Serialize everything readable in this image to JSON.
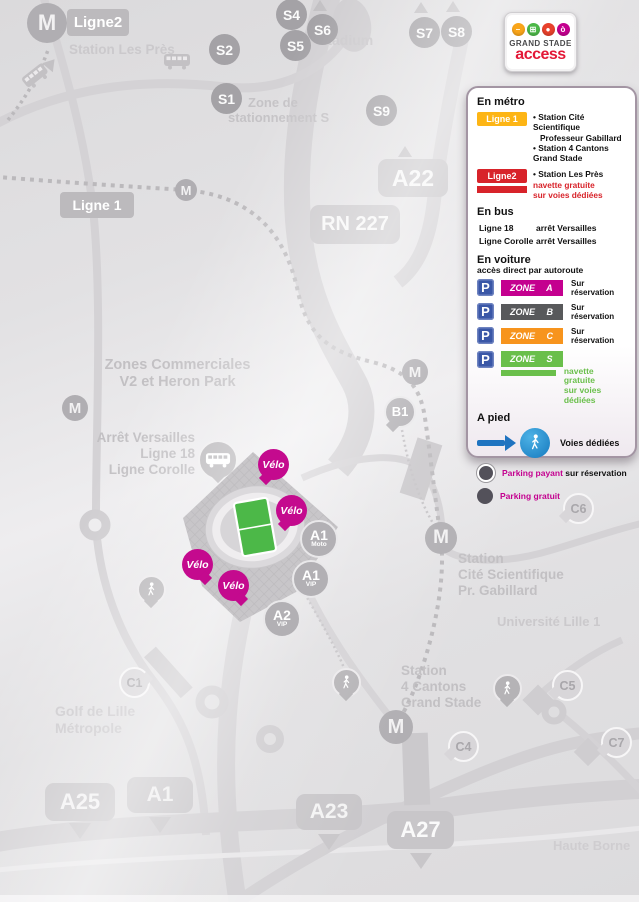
{
  "logo": {
    "brand_line1": "GRAND STADE",
    "brand_line2": "access",
    "icons": [
      {
        "name": "metro-icon",
        "color": "#f9a51a"
      },
      {
        "name": "bus-icon",
        "color": "#4cb848"
      },
      {
        "name": "car-icon",
        "color": "#e8412c"
      },
      {
        "name": "bike-icon",
        "color": "#c4008f"
      }
    ]
  },
  "legend": {
    "metro_heading": "En métro",
    "ligne1_label": "Ligne 1",
    "ligne1_station1a": "• Station Cité Scientifique",
    "ligne1_station1b": "Professeur Gabillard",
    "ligne1_station2": "• Station 4 Cantons Grand Stade",
    "ligne2_label": "Ligne2",
    "ligne2_station": "• Station Les Près",
    "ligne2_note1": "navette gratuite",
    "ligne2_note2": "sur voies dédiées",
    "bus_heading": "En bus",
    "bus_rows": [
      {
        "line": "Ligne 18",
        "stop": "arrêt Versailles"
      },
      {
        "line": "Ligne Corolle",
        "stop": "arrêt Versailles"
      }
    ],
    "car_heading": "En voiture",
    "car_sub": "accès direct par autoroute",
    "p_label": "P",
    "zones": [
      {
        "label": "ZONE A",
        "color": "#c4008f",
        "note": "Sur réservation"
      },
      {
        "label": "ZONE B",
        "color": "#58595b",
        "note": "Sur réservation"
      },
      {
        "label": "ZONE C",
        "color": "#f7941d",
        "note": "Sur réservation"
      },
      {
        "label": "ZONE S",
        "color": "#6abf4b",
        "note1": "navette gratuite",
        "note2": "sur voies dédiées"
      }
    ],
    "foot_heading": "A pied",
    "foot_note": "Voies dédiées",
    "parking_paid_label": "Parking payant",
    "parking_paid_suffix": " sur réservation",
    "parking_free_label": "Parking gratuit"
  },
  "map": {
    "m": "M",
    "ligne2_label": "Ligne2",
    "station_les_pres": "Station Les Près",
    "s_markers": [
      "S1",
      "S2",
      "S4",
      "S5",
      "S6",
      "S7",
      "S8",
      "S9"
    ],
    "stadium_text": "Stadium",
    "zone_stationnement1": "Zone de",
    "zone_stationnement2": "stationnement S",
    "ligne1_label": "Ligne 1",
    "rn227": "RN 227",
    "a22": "A22",
    "zones_comm1": "Zones Commerciales",
    "zones_comm2": "V2 et Heron Park",
    "arret1": "Arrêt Versailles",
    "arret2": "Ligne 18",
    "arret3": "Ligne Corolle",
    "b1": "B1",
    "velo": "Vélo",
    "gates": [
      {
        "top": "A1",
        "bottom": "Moto"
      },
      {
        "top": "A1",
        "bottom": "VIP"
      },
      {
        "top": "A2",
        "bottom": "VIP"
      }
    ],
    "station_cite1": "Station",
    "station_cite2": "Cité Scientifique",
    "station_cite3": "Pr. Gabillard",
    "universite": "Université Lille 1",
    "station_4c1": "Station",
    "station_4c2": "4 Cantons",
    "station_4c3": "Grand Stade",
    "golf1": "Golf de Lille",
    "golf2": "Métropole",
    "haute_borne": "Haute Borne",
    "c_markers": [
      "C1",
      "C4",
      "C5",
      "C6",
      "C7"
    ],
    "bottom_roads": [
      "A25",
      "A1",
      "A23",
      "A27"
    ]
  },
  "colors": {
    "magenta": "#c4008f",
    "metro_yellow": "#fdb515",
    "metro_red": "#d8232a",
    "parking_blue": "#3a57a7",
    "walk_blue": "#1f74c0",
    "zone_orange": "#f7941d",
    "zone_green": "#6abf4b",
    "zone_gray": "#58595b",
    "pitch_green": "#4cb848",
    "brand_red": "#e31837"
  }
}
